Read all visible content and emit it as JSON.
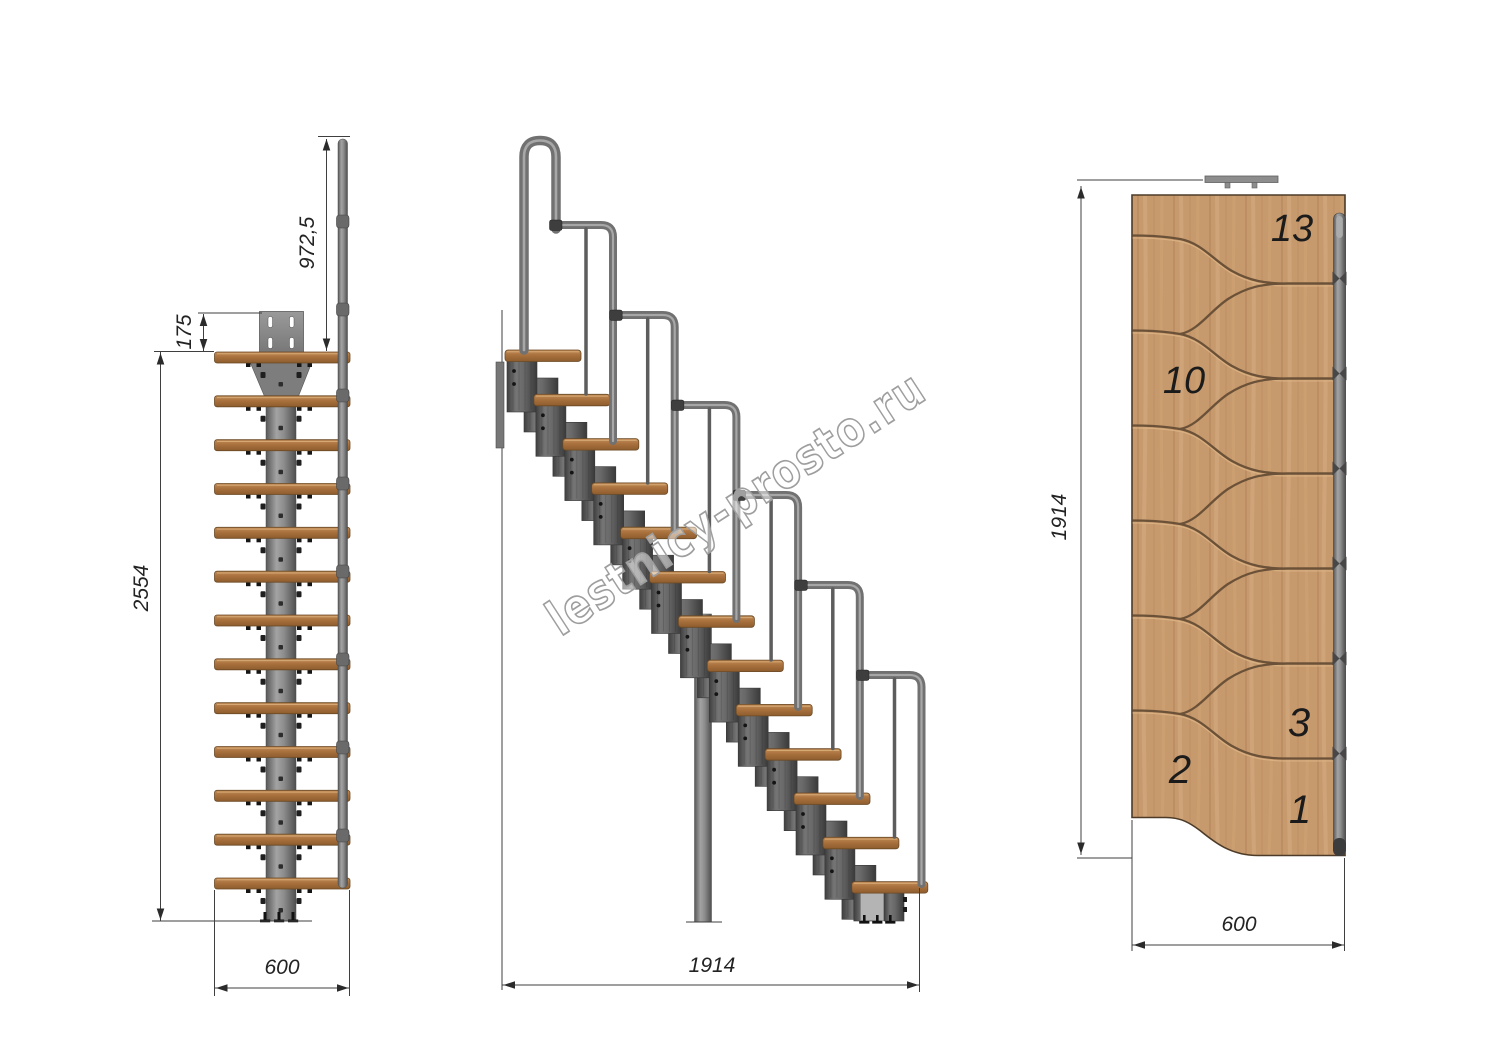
{
  "front_view": {
    "dim_handrail_height": "972,5",
    "dim_plate_offset": "175",
    "dim_total_height": "2554",
    "dim_width": "600"
  },
  "side_view": {
    "dim_length": "1914"
  },
  "plan_view": {
    "dim_length": "1914",
    "dim_width": "600",
    "labels": {
      "step13": "13",
      "step10": "10",
      "step3": "3",
      "step2": "2",
      "step1": "1"
    }
  },
  "watermark": {
    "text": "lestnicy-prosto.ru"
  },
  "colors": {
    "wood_plan": "#c79a6d",
    "wood_tread": "#a9713d",
    "metal": "#7a7a7a",
    "metal_dark": "#565656",
    "line": "#3f3f3f"
  }
}
